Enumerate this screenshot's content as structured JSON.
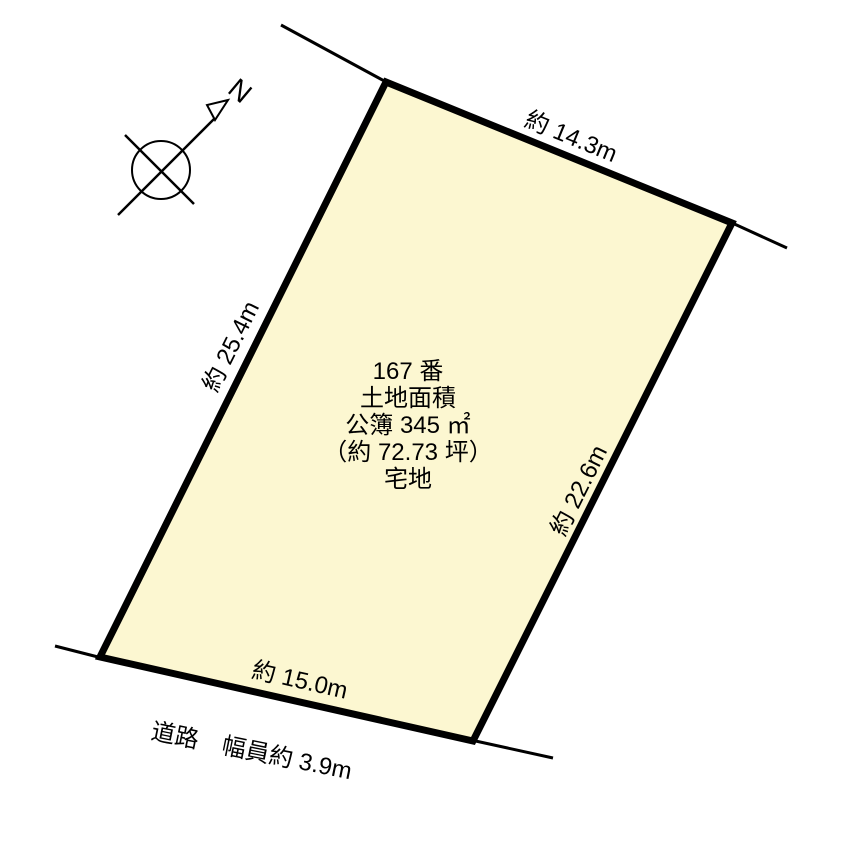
{
  "colors": {
    "background": "#FFFFFF",
    "plot_fill": "#FCF7D1",
    "line": "#000000"
  },
  "compass": {
    "north_label": "N"
  },
  "plot": {
    "info_lines": [
      "167 番",
      "土地面積",
      "公簿 345 ㎡",
      "（約 72.73 坪）",
      "宅地"
    ],
    "dimensions": {
      "top": "約 14.3m",
      "left": "約 25.4m",
      "right": "約 22.6m",
      "bottom": "約 15.0m"
    }
  },
  "road": {
    "label": "道路　幅員約 3.9m"
  }
}
